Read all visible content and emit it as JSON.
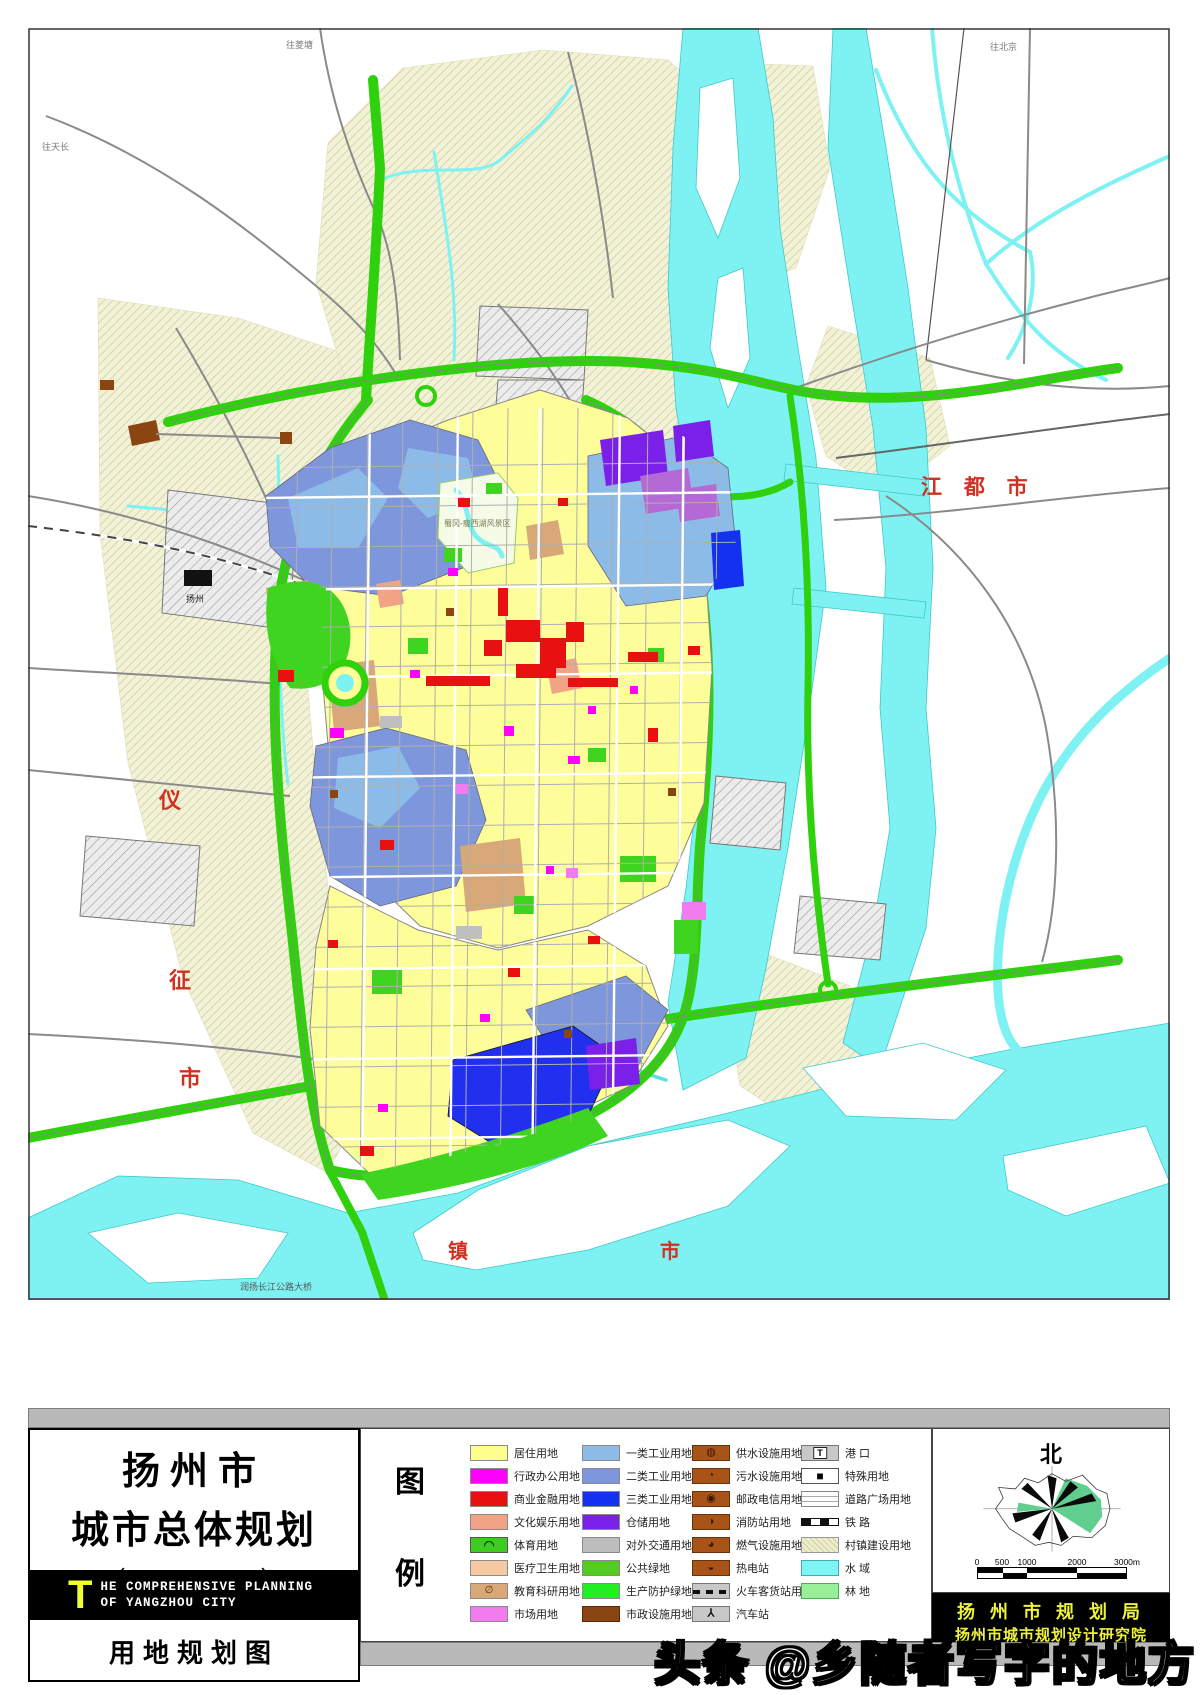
{
  "title_block": {
    "line1": "扬州市",
    "line2": "城市总体规划",
    "line3": "（2002-2020）",
    "en_initial": "T",
    "en_line1": "HE COMPREHENSIVE PLANNING",
    "en_line2": "OF YANGZHOU CITY",
    "subtitle": "用地规划图"
  },
  "legend": {
    "glyph_top": "图",
    "glyph_bottom": "例",
    "col1": [
      {
        "label": "居住用地",
        "swatch": "background:#FEFE8C;border:1px solid #8a8a8a"
      },
      {
        "label": "行政办公用地",
        "swatch": "background:#FF00FF;border:1px solid #8a8a8a"
      },
      {
        "label": "商业金融用地",
        "swatch": "background:#E81010;border:1px solid #8a8a8a"
      },
      {
        "label": "文化娱乐用地",
        "swatch": "background:#F2A385;border:1px solid #8a8a8a"
      },
      {
        "label": "体育用地",
        "swatch": "background:#3ECC20;border:1px solid #555",
        "icon": "◠",
        "icon_style": "color:#0a4a0a;font-size:13px;font-weight:bold"
      },
      {
        "label": "医疗卫生用地",
        "swatch": "background:#F6C9A0;border:1px solid #8a8a8a"
      },
      {
        "label": "教育科研用地",
        "swatch": "background:#D8A878;border:1px solid #8a8a8a",
        "icon": "∅",
        "icon_style": "color:#58300a;font-size:10px"
      },
      {
        "label": "市场用地",
        "swatch": "background:#F07CF0;border:1px solid #8a8a8a"
      }
    ],
    "col2": [
      {
        "label": "一类工业用地",
        "swatch": "background:#8CBBE8;border:1px solid #8a8a8a"
      },
      {
        "label": "二类工业用地",
        "swatch": "background:#7E96DC;border:1px solid #8a8a8a"
      },
      {
        "label": "三类工业用地",
        "swatch": "background:#1430F0;border:1px solid #8a8a8a"
      },
      {
        "label": "仓储用地",
        "swatch": "background:#7B20E8;border:1px solid #8a8a8a"
      },
      {
        "label": "对外交通用地",
        "swatch": "background:#BDBDBD;border:1px solid #8a8a8a"
      },
      {
        "label": "公共绿地",
        "swatch": "background:#55CC22;border:1px solid #8a8a8a"
      },
      {
        "label": "生产防护绿地",
        "swatch": "background:#22EE22;border:1px solid #8a8a8a"
      },
      {
        "label": "市政设施用地",
        "swatch": "background:#8B4513;border:1px solid #5a2a08"
      }
    ],
    "col3": [
      {
        "label": "供水设施用地",
        "swatch": "background:#A85418;border:1px solid #6a3008",
        "icon": "◍",
        "icon_style": "color:#3a1604;font-size:11px"
      },
      {
        "label": "污水设施用地",
        "swatch": "background:#A85418;border:1px solid #6a3008",
        "icon": "◔",
        "icon_style": "color:#3a1604;font-size:11px"
      },
      {
        "label": "邮政电信用地",
        "swatch": "background:#A85418;border:1px solid #6a3008",
        "icon": "◉",
        "icon_style": "color:#3a1604;font-size:11px"
      },
      {
        "label": "消防站用地",
        "swatch": "background:#A85418;border:1px solid #6a3008",
        "icon": "◑",
        "icon_style": "color:#3a1604;font-size:11px"
      },
      {
        "label": "燃气设施用地",
        "swatch": "background:#A85418;border:1px solid #6a3008",
        "icon": "◕",
        "icon_style": "color:#3a1604;font-size:11px"
      },
      {
        "label": "热电站",
        "swatch": "background:#A85418;border:1px solid #6a3008",
        "icon": "◒",
        "icon_style": "color:#3a1604;font-size:11px"
      },
      {
        "label": "火车客货站用地",
        "swatch": "background-color:#C8C8C8;background-image:repeating-linear-gradient(90deg,#111 0 7px,transparent 7px 13px);background-size:100% 4px;background-position:0 6px;background-repeat:no-repeat;border:1px solid #777"
      },
      {
        "label": "汽车站",
        "swatch": "background:#C8C8C8;border:1px solid #777",
        "icon": "⅄",
        "icon_style": "color:#111;font-size:11px;font-weight:bold"
      }
    ],
    "col4": [
      {
        "label": "港  口",
        "swatch": "background:#C8C8C8;border:1px solid #777",
        "icon": "T",
        "icon_style": "background:#fff;border:1px solid #222;color:#000;font-size:9px;font-weight:bold;padding:0 3px;line-height:10px"
      },
      {
        "label": "特殊用地",
        "swatch": "background:#fff;border:1px solid #555",
        "icon": "■",
        "icon_style": "color:#000;font-size:12px"
      },
      {
        "label": "道路广场用地",
        "swatch": "background-color:#fff;background-image:repeating-linear-gradient(0deg,transparent 0 4px,#aaa 4px 5px);border:1px solid #888"
      },
      {
        "label": "铁  路",
        "swatch": "height:8px;margin:4px 0;background:repeating-linear-gradient(90deg,#111 0 9px,#fff 9px 18px);border:1px solid #111"
      },
      {
        "label": "村镇建设用地",
        "swatch": "background:repeating-linear-gradient(45deg,#EDEDCB 0 3px,#CFCFA2 3px 4px);border:1px solid #999"
      },
      {
        "label": "水  域",
        "swatch": "background:#7FF4F4;border:1px solid #44AAAA"
      },
      {
        "label": "林  地",
        "swatch": "background:#97F097;border:1px solid #55AA55"
      }
    ]
  },
  "compass": {
    "north": "北"
  },
  "scale_bar": {
    "t0": "0",
    "t1": "500",
    "t2": "1000",
    "t3": "2000",
    "t4": "3000m"
  },
  "attribution": {
    "line1": "扬 州 市 规 划 局",
    "line2": "扬州市城市规划设计研究院"
  },
  "watermark": "头条 @乡随者写字的地方",
  "map": {
    "labels": {
      "jiangdu": "江  都  市",
      "yi": "仪",
      "zheng": "征",
      "shi_west": "市",
      "zhen": "镇",
      "shi_south": "市",
      "bridge": "润扬长江公路大桥",
      "to_lingtang": "往菱塘",
      "to_beijing": "往北京",
      "to_tianchang": "往天长",
      "station": "扬州",
      "scenic": "蜀冈-瘦西湖风景区"
    }
  }
}
